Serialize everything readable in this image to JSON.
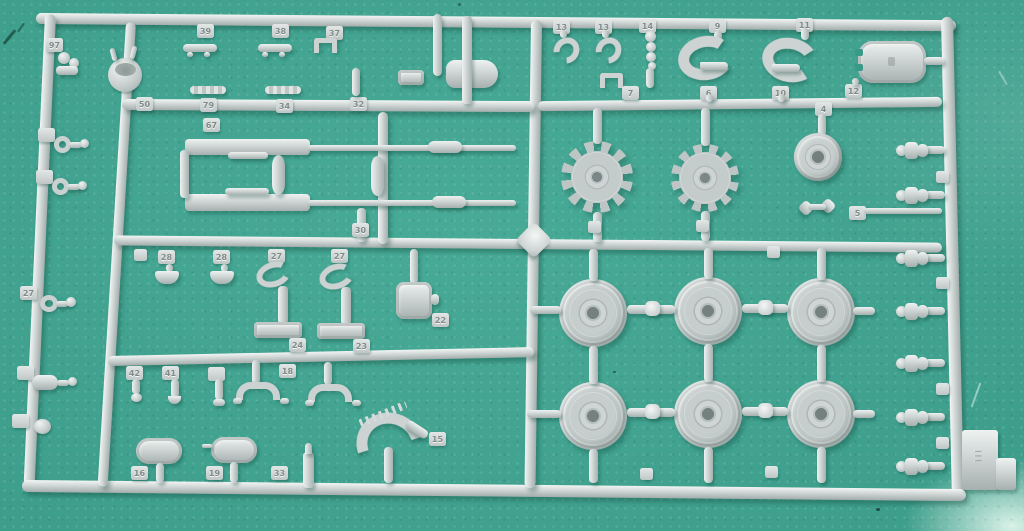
{
  "meta": {
    "subject": "Photograph of a light-grey injection-moulded model kit sprue (parts runner) lying on a teal-green self-healing cutting mat",
    "parts_inventory": [
      "drive sprocket wheel x2",
      "road wheel x6",
      "idler wheel hub x1",
      "machine-gun barrel assembly x2",
      "shovel x1",
      "tow hook x2",
      "horseshoe clamp x2",
      "rectangular hatch x1",
      "oval hatch cover x2",
      "periscope guard x2",
      "headlight bucket x1",
      "curved toothed fender section x1",
      "suspension bolt cap x7",
      "assorted small clamps, pins and eyelets"
    ],
    "gate_block_mark": "III"
  },
  "theme": {
    "mat_color": "#3a9a88",
    "mat_light": "#48ab97",
    "mat_dark": "#2f8a79",
    "plastic_color": "#ccd3d2",
    "plastic_highlight": "#f2f5f4",
    "plastic_shadow": "#a3adac"
  },
  "sprue": {
    "tabs": {
      "t97": "97",
      "t39": "39",
      "t38": "38",
      "t37": "37",
      "t13a": "13",
      "t13b": "13",
      "t14": "14",
      "t9": "9",
      "t11": "11",
      "t50": "50",
      "t79": "79",
      "t34": "34",
      "t32": "32",
      "t67": "67",
      "t30": "30",
      "t7": "7",
      "t6": "6",
      "t10": "10",
      "t12": "12",
      "t4": "4",
      "t5": "5",
      "t28a": "28",
      "t28b": "28",
      "t27a": "27",
      "t27b": "27",
      "t22": "22",
      "t24": "24",
      "t23": "23",
      "t42": "42",
      "t41": "41",
      "t40": "",
      "t18": "18",
      "t16": "16",
      "t19": "19",
      "t33": "33",
      "t15": "15",
      "t27c": "27",
      "t51a": "",
      "t51b": "",
      "t70": "",
      "tknob": "",
      "ts1": "",
      "ts2": "",
      "tb1": "",
      "tb2": "",
      "tr2l": "",
      "tr2r": "",
      "trr1": "",
      "trr2": "",
      "trr3": "",
      "trr4": ""
    }
  }
}
